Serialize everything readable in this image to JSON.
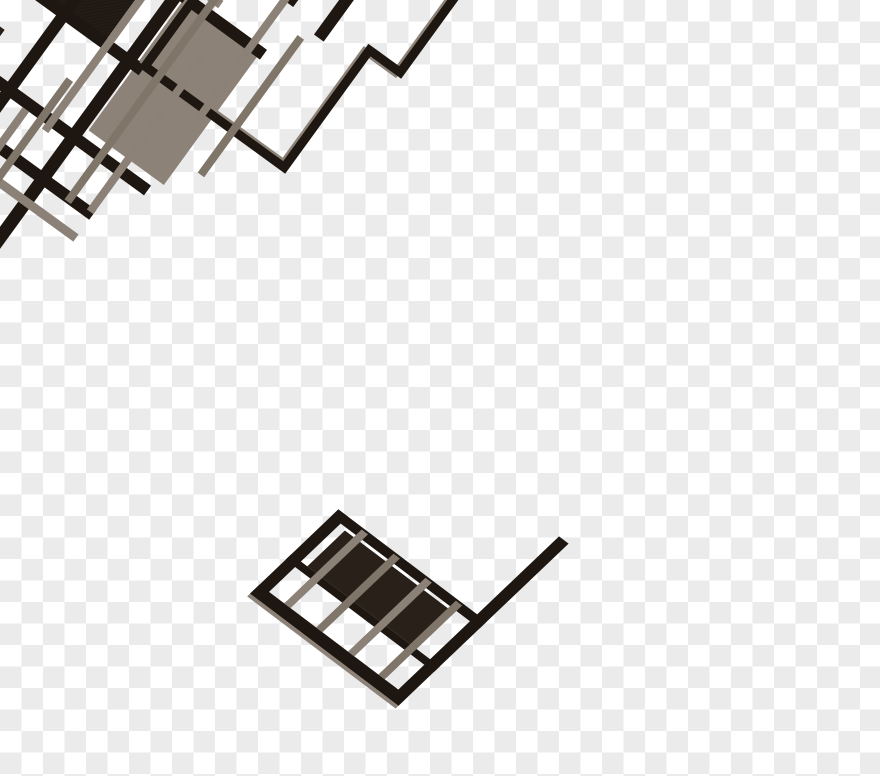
{
  "background": {
    "checker_light": "#ffffff",
    "checker_dark": "#ebebeb",
    "cell_size_px": 21.5
  },
  "plan": {
    "rotation_deg": 36,
    "pivot": [
      455,
      48
    ],
    "wing_matrix": [
      0.798,
      0.603,
      -0.724,
      0.69,
      535.4,
      110.3
    ],
    "colors": {
      "wall": "#1e1711",
      "beam": "#8b8177",
      "beamD": "#7f7569",
      "slab": "#8d8278",
      "slabLight": "#978d83",
      "glaze": "#c8c1b8",
      "roomMed": "#342b24",
      "roomDark": "#231b15",
      "roomDark2": "#292019",
      "colFill": "#edeae5"
    },
    "shapes": [
      {
        "n": "slab-upper-left",
        "g": "m",
        "t": "r",
        "x": -48,
        "y": 300,
        "w": 110,
        "h": 98,
        "f": "slabLight"
      },
      {
        "n": "slab-terrace",
        "g": "m",
        "t": "r",
        "x": 207,
        "y": 160,
        "w": 93,
        "h": 170,
        "f": "slab"
      },
      {
        "n": "slab-walkway",
        "g": "m",
        "t": "r",
        "x": -70,
        "y": 392,
        "w": 62,
        "h": 49,
        "f": "slab"
      },
      {
        "n": "slab-spine-edge",
        "g": "m",
        "t": "r",
        "x": -25,
        "y": 230,
        "w": 6,
        "h": 355,
        "f": "slab"
      },
      {
        "n": "slab-lower-wall-edge",
        "g": "m",
        "t": "r",
        "x": -20,
        "y": 498,
        "w": 145,
        "h": 5,
        "f": "slab"
      },
      {
        "n": "room-dark-upper-a",
        "g": "m",
        "t": "r",
        "x": -16,
        "y": 182,
        "w": 94,
        "h": 68,
        "f": "roomMed"
      },
      {
        "n": "room-dark-upper-b",
        "g": "m",
        "t": "r",
        "x": 78,
        "y": 182,
        "w": 90,
        "h": 68,
        "f": "roomDark"
      },
      {
        "n": "room-hatch-upper",
        "g": "m",
        "t": "r",
        "x": 95,
        "y": 192,
        "w": 73,
        "h": 58,
        "f": "url(#hatch)"
      },
      {
        "n": "room-dark-L",
        "g": "m",
        "t": "p",
        "d": "M-10,298 H80 V348 H28 V370 H-10 Z",
        "f": "roomDark2"
      },
      {
        "n": "room-dark-lower",
        "g": "m",
        "t": "r",
        "x": -48,
        "y": 370,
        "w": 143,
        "h": 82,
        "f": "roomDark2"
      },
      {
        "n": "room-hatch-lower",
        "g": "m",
        "t": "r",
        "x": 40,
        "y": 400,
        "w": 55,
        "h": 52,
        "f": "url(#hatch)"
      },
      {
        "n": "wall-spine",
        "g": "m",
        "t": "r",
        "x": -20,
        "y": 0,
        "w": 16,
        "h": 585,
        "f": "wall"
      },
      {
        "n": "wall-top-corner",
        "g": "m",
        "t": "r",
        "x": 0,
        "y": 0,
        "w": 32,
        "h": 12,
        "f": "wall"
      },
      {
        "n": "wall-top-step",
        "g": "m",
        "t": "r",
        "x": 30,
        "y": 0,
        "w": 28,
        "h": 24,
        "f": "wall"
      },
      {
        "n": "wall-top-edge",
        "g": "m",
        "t": "r",
        "x": 56,
        "y": 12,
        "w": 146,
        "h": 12,
        "f": "wall"
      },
      {
        "n": "wall-tooth-1",
        "g": "m",
        "t": "r",
        "x": 84,
        "y": 24,
        "w": 16,
        "h": 16,
        "f": "wall"
      },
      {
        "n": "wall-tooth-2",
        "g": "m",
        "t": "r",
        "x": 140,
        "y": 24,
        "w": 16,
        "h": 16,
        "f": "wall"
      },
      {
        "n": "wall-corridor-right",
        "g": "m",
        "t": "r",
        "x": 192,
        "y": 8,
        "w": 13,
        "h": 562,
        "f": "wall"
      },
      {
        "n": "wall-corridor-left",
        "g": "m",
        "t": "r",
        "x": 113,
        "y": 180,
        "w": 12,
        "h": 390,
        "f": "wall"
      },
      {
        "n": "wall-cross-1",
        "g": "m",
        "t": "r",
        "x": -4,
        "y": 244,
        "w": 219,
        "h": 12,
        "f": "wall"
      },
      {
        "n": "wall-cross-2",
        "g": "m",
        "t": "r",
        "x": 55,
        "y": 338,
        "w": 235,
        "h": 12,
        "f": "wall"
      },
      {
        "n": "wall-cross-3",
        "g": "m",
        "t": "r",
        "x": 115,
        "y": 390,
        "w": 145,
        "h": 12,
        "f": "wall"
      },
      {
        "n": "wall-attach-1",
        "g": "m",
        "t": "r",
        "x": 204,
        "y": 98,
        "w": 96,
        "h": 12,
        "f": "wall"
      },
      {
        "n": "wall-attach-2",
        "g": "m",
        "t": "r",
        "x": 204,
        "y": 160,
        "w": 100,
        "h": 12,
        "f": "wall"
      },
      {
        "n": "wall-wing-divider",
        "g": "m",
        "t": "r",
        "x": 333,
        "y": 40,
        "w": 12,
        "h": 80,
        "f": "wall"
      },
      {
        "n": "wall-lower-left",
        "g": "m",
        "t": "r",
        "x": -20,
        "y": 484,
        "w": 145,
        "h": 14,
        "f": "wall"
      },
      {
        "n": "wall-hook-a",
        "g": "m",
        "t": "r",
        "x": 22,
        "y": 452,
        "w": 70,
        "h": 8,
        "f": "wall"
      },
      {
        "n": "wall-hook-b",
        "g": "m",
        "t": "r",
        "x": 14,
        "y": 438,
        "w": 10,
        "h": 22,
        "f": "wall"
      },
      {
        "n": "wall-hook-c",
        "g": "m",
        "t": "r",
        "x": 14,
        "y": 415,
        "w": 12,
        "h": 83,
        "f": "wall"
      },
      {
        "n": "vestibule-outline",
        "g": "m",
        "t": "r",
        "x": 180,
        "y": -12,
        "w": 55,
        "h": 47,
        "s": "wall",
        "sw": 8
      },
      {
        "n": "wing-outline-shadow",
        "g": "m",
        "t": "p",
        "d": "M211.5,-26.5 H421.5 V103.5 H383.5 V241.5 H211.5 Z",
        "s": "slab",
        "sw": 7
      },
      {
        "n": "wing-outline",
        "g": "m",
        "t": "p",
        "d": "M215,-30 H425 V100 H387 V245 H215 Z",
        "s": "wall",
        "sw": 9
      },
      {
        "n": "walkway-box",
        "g": "m",
        "t": "r",
        "x": -68,
        "y": 385,
        "w": 46,
        "h": 57,
        "s": "wall",
        "sw": 7
      },
      {
        "n": "walkway-outline-dark",
        "g": "m",
        "t": "p",
        "d": "M-13,387 H-193 V440 H-13",
        "s": "wall",
        "sw": 3
      },
      {
        "n": "walkway-cap",
        "g": "m",
        "t": "r",
        "x": -196,
        "y": 385,
        "w": 12,
        "h": 62,
        "f": "wall"
      },
      {
        "n": "walkway-outline",
        "g": "m",
        "t": "p",
        "d": "M-10,390 H-190 V443 H-10",
        "s": "beam",
        "sw": 5
      },
      {
        "n": "walkway-glazing-1",
        "g": "m",
        "t": "l",
        "x1": -60,
        "y1": 392,
        "x2": -88,
        "y2": 441,
        "s": "glaze",
        "sw": 1.5
      },
      {
        "n": "walkway-glazing-2",
        "g": "m",
        "t": "l",
        "x1": -105,
        "y1": 392,
        "x2": -133,
        "y2": 441,
        "s": "glaze",
        "sw": 1.5
      },
      {
        "n": "walkway-glazing-3",
        "g": "m",
        "t": "l",
        "x1": -150,
        "y1": 392,
        "x2": -178,
        "y2": 441,
        "s": "glaze",
        "sw": 1.5
      },
      {
        "n": "beam-1",
        "g": "m",
        "t": "r",
        "x": -16,
        "y": 84,
        "w": 316,
        "h": 9,
        "f": "beam"
      },
      {
        "n": "beam-2",
        "g": "m",
        "t": "r",
        "x": -16,
        "y": 146,
        "w": 256,
        "h": 9,
        "f": "beam"
      },
      {
        "n": "beam-3",
        "g": "m",
        "t": "r",
        "x": -48,
        "y": 278,
        "w": 108,
        "h": 9,
        "f": "beam"
      },
      {
        "n": "beam-4",
        "g": "m",
        "t": "r",
        "x": 115,
        "y": 420,
        "w": 145,
        "h": 9,
        "f": "beam"
      },
      {
        "n": "post-1",
        "g": "m",
        "t": "r",
        "x": 168,
        "y": 148,
        "w": 8,
        "h": 208,
        "f": "beam"
      },
      {
        "n": "post-2",
        "g": "m",
        "t": "r",
        "x": 228,
        "y": 110,
        "w": 8,
        "h": 290,
        "f": "beamD"
      },
      {
        "n": "post-3",
        "g": "m",
        "t": "r",
        "x": 252,
        "y": 200,
        "w": 8,
        "h": 195,
        "f": "beam"
      },
      {
        "n": "post-4",
        "g": "m",
        "t": "r",
        "x": 140,
        "y": 350,
        "w": 8,
        "h": 220,
        "f": "beam"
      },
      {
        "n": "post-5",
        "g": "m",
        "t": "r",
        "x": 158,
        "y": 300,
        "w": 8,
        "h": 270,
        "f": "beamD"
      },
      {
        "n": "post-6",
        "g": "m",
        "t": "r",
        "x": 285,
        "y": 100,
        "w": 8,
        "h": 160,
        "f": "beam"
      },
      {
        "n": "post-7",
        "g": "m",
        "t": "r",
        "x": 320,
        "y": 130,
        "w": 8,
        "h": 170,
        "f": "beamD"
      },
      {
        "n": "column-1",
        "g": "m",
        "t": "r",
        "x": 156,
        "y": 124,
        "w": 18,
        "h": 18,
        "f": "colFill",
        "s": "wall",
        "sw": 5
      },
      {
        "n": "column-2",
        "g": "m",
        "t": "r",
        "x": 137,
        "y": 417,
        "w": 18,
        "h": 18,
        "f": "colFill",
        "s": "wall",
        "sw": 5
      },
      {
        "n": "column-3",
        "g": "m",
        "t": "r",
        "x": -26,
        "y": 357,
        "w": 15,
        "h": 15,
        "f": "colFill",
        "s": "slab",
        "sw": 4
      },
      {
        "n": "wing-room-dark",
        "g": "w",
        "t": "r",
        "x": 175,
        "y": 456,
        "w": 135,
        "h": 52,
        "f": "roomDark2"
      },
      {
        "n": "wing-wall-left",
        "g": "w",
        "t": "r",
        "x": 155,
        "y": 443,
        "w": 12,
        "h": 122,
        "f": "wall"
      },
      {
        "n": "wing-wall-right",
        "g": "w",
        "t": "r",
        "x": 329,
        "y": 330,
        "w": 12,
        "h": 235,
        "f": "wall"
      },
      {
        "n": "wing-wall-top",
        "g": "w",
        "t": "r",
        "x": 155,
        "y": 443,
        "w": 186,
        "h": 10,
        "f": "wall"
      },
      {
        "n": "wing-wall-mid",
        "g": "w",
        "t": "r",
        "x": 155,
        "y": 508,
        "w": 186,
        "h": 8,
        "f": "wall"
      },
      {
        "n": "wing-wall-bottom",
        "g": "w",
        "t": "r",
        "x": 155,
        "y": 552,
        "w": 186,
        "h": 13,
        "f": "wall"
      },
      {
        "n": "wing-wall-bottom-edge",
        "g": "w",
        "t": "r",
        "x": 155,
        "y": 565,
        "w": 186,
        "h": 4,
        "f": "slab"
      },
      {
        "n": "wing-post-1",
        "g": "w",
        "t": "r",
        "x": 186,
        "y": 445,
        "w": 8,
        "h": 107,
        "f": "beam"
      },
      {
        "n": "wing-post-2",
        "g": "w",
        "t": "r",
        "x": 226,
        "y": 445,
        "w": 8,
        "h": 107,
        "f": "beamD"
      },
      {
        "n": "wing-post-3",
        "g": "w",
        "t": "r",
        "x": 266,
        "y": 445,
        "w": 8,
        "h": 107,
        "f": "beam"
      },
      {
        "n": "wing-post-4",
        "g": "w",
        "t": "r",
        "x": 304,
        "y": 445,
        "w": 8,
        "h": 107,
        "f": "beamD"
      }
    ]
  }
}
